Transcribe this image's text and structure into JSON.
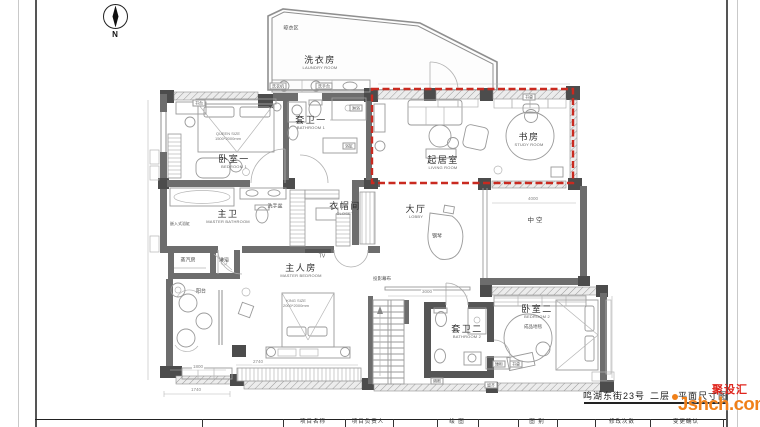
{
  "colors": {
    "wall_gray": "#6d6d6d",
    "pillar_gray": "#4c4c4c",
    "furniture_gray": "#9a9a9a",
    "red_dashed": "#c92a20",
    "watermark_orange": "#f08019",
    "watermark_red": "#e0251d",
    "title_text": "#1c1c1c"
  },
  "compass": {
    "label": "N"
  },
  "rooms": [
    {
      "cn": "洗衣房",
      "en": "LAUNDRY ROOM"
    },
    {
      "cn": "套卫一",
      "en": "BATHROOM 1"
    },
    {
      "cn": "卧室一",
      "en": "BEDROOM 1"
    },
    {
      "cn": "起居室",
      "en": "LIVING ROOM"
    },
    {
      "cn": "书房",
      "en": "STUDY ROOM"
    },
    {
      "cn": "主卫",
      "en": "MASTER BATHROOM"
    },
    {
      "cn": "衣帽间",
      "en": "CLOSET"
    },
    {
      "cn": "大厅",
      "en": "LOBBY"
    },
    {
      "cn": "主人房",
      "en": "MASTER BEDROOM"
    },
    {
      "cn": "套卫二",
      "en": "BATHROOM 2"
    },
    {
      "cn": "卧室二",
      "en": "BEDROOM 2"
    }
  ],
  "annotations": [
    {
      "text": "晾衣区"
    },
    {
      "text": "书桌"
    },
    {
      "text": "洗衣机"
    },
    {
      "text": "洗手台"
    },
    {
      "text": "书台"
    },
    {
      "text": "淋浴"
    },
    {
      "text": "浴缸"
    },
    {
      "text": "洗手盆"
    },
    {
      "text": "钢琴"
    },
    {
      "text": "中空"
    },
    {
      "text": "TV"
    },
    {
      "text": "蒸汽房"
    },
    {
      "text": "淋浴"
    },
    {
      "text": "嵌入式浴缸"
    },
    {
      "text": "阳台"
    },
    {
      "text": "投影幕布"
    },
    {
      "text": "成品地毯"
    },
    {
      "text": "矮柜"
    },
    {
      "text": "书桌"
    },
    {
      "text": "隔断"
    },
    {
      "text": "留齐"
    }
  ],
  "bed_specs": [
    {
      "line1": "QUEEN SIZE",
      "line2": "1500*2000mm"
    },
    {
      "line1": "KING SIZE",
      "line2": "2000*2000mm"
    }
  ],
  "dimensions": [
    {
      "value": "1740"
    },
    {
      "value": "1800"
    },
    {
      "value": "2740"
    },
    {
      "value": "3000"
    },
    {
      "value": "4000"
    }
  ],
  "title_block": {
    "project_title_part1": "鸣湖东街23号",
    "project_title_part2": "二层",
    "project_title_part3": "平面尺寸图",
    "cells": [
      "项目名称",
      "项目负责人",
      "绘 图",
      "图 别",
      "修改次数",
      "变更确认"
    ]
  },
  "watermark": {
    "site_name_cn": "聚设汇",
    "site_name_en": "Jshch.com"
  }
}
